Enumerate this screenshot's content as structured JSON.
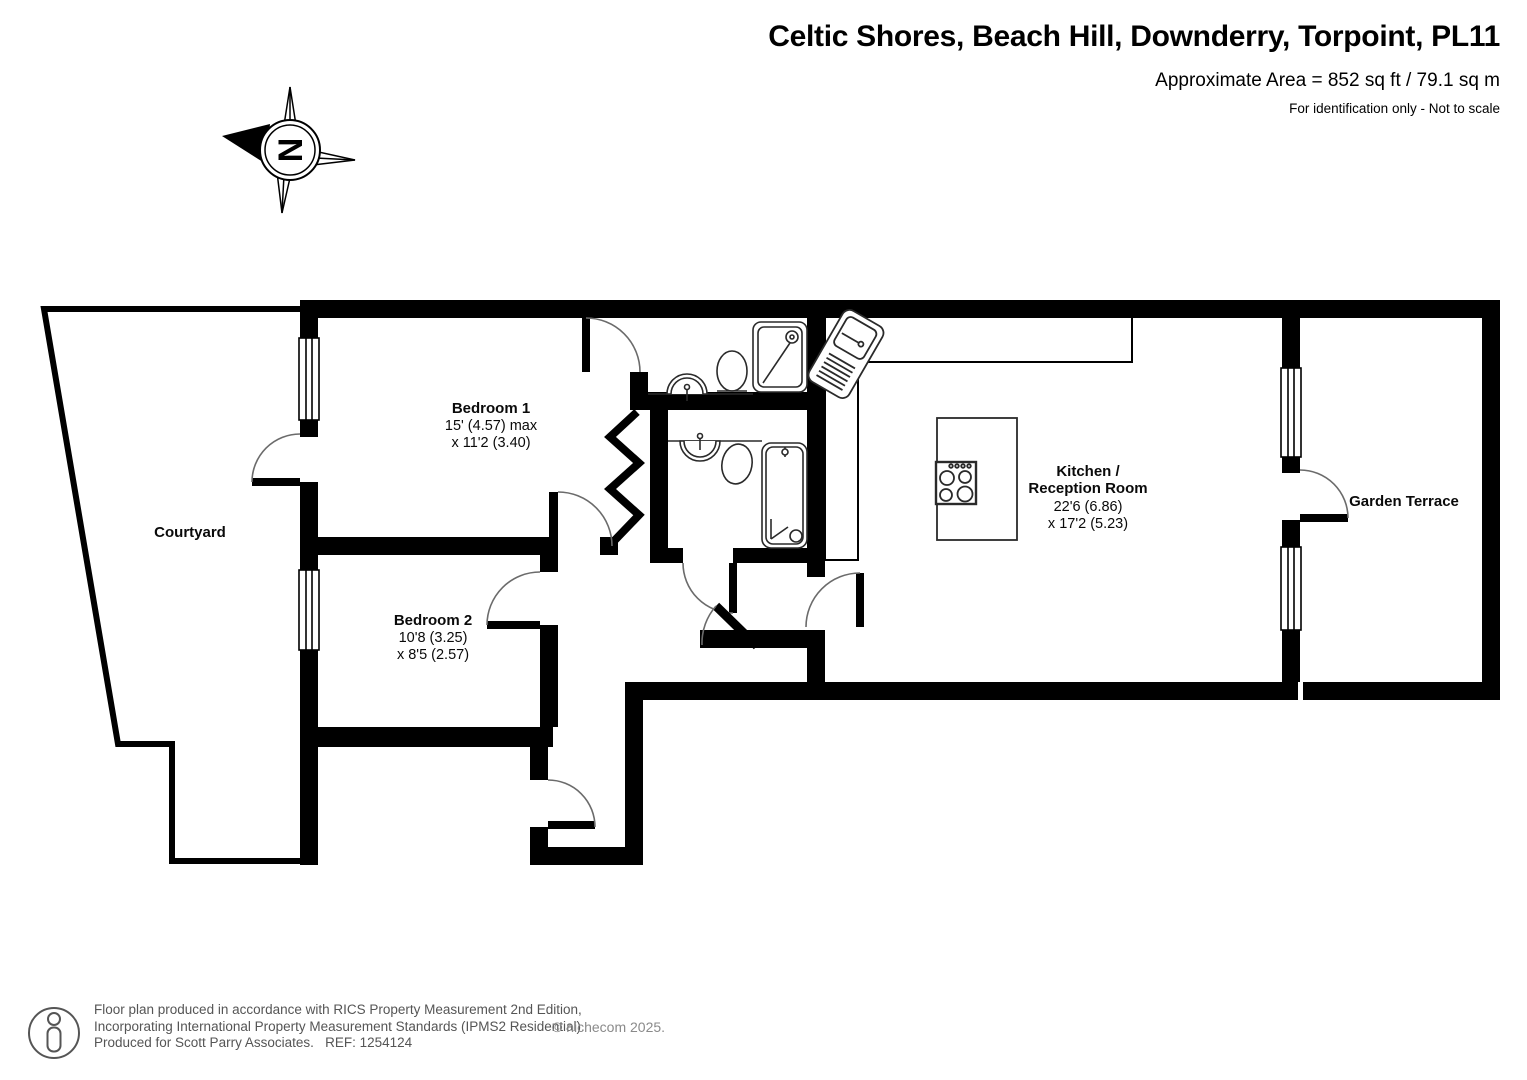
{
  "header": {
    "title": "Celtic Shores, Beach Hill, Downderry, Torpoint, PL11",
    "area": "Approximate Area = 852 sq ft / 79.1 sq m",
    "note": "For identification only - Not to scale"
  },
  "compass": {
    "label": "N"
  },
  "rooms": {
    "courtyard": {
      "name": "Courtyard"
    },
    "bedroom1": {
      "name": "Bedroom 1",
      "dim1": "15' (4.57) max",
      "dim2": "x 11'2 (3.40)"
    },
    "bedroom2": {
      "name": "Bedroom 2",
      "dim1": "10'8 (3.25)",
      "dim2": "x 8'5 (2.57)"
    },
    "kitchen": {
      "name_line1": "Kitchen /",
      "name_line2": "Reception Room",
      "dim1": "22'6 (6.86)",
      "dim2": "x 17'2 (5.23)"
    },
    "garden_terrace": {
      "name": "Garden Terrace"
    }
  },
  "footer": {
    "line1": "Floor plan produced in accordance with RICS Property Measurement 2nd Edition,",
    "line2": "Incorporating International Property Measurement Standards (IPMS2 Residential).",
    "line3": "Produced for Scott Parry Associates.   REF: 1254124",
    "copyright": "© nichecom 2025."
  },
  "colors": {
    "wall": "#000000",
    "background": "#ffffff"
  }
}
